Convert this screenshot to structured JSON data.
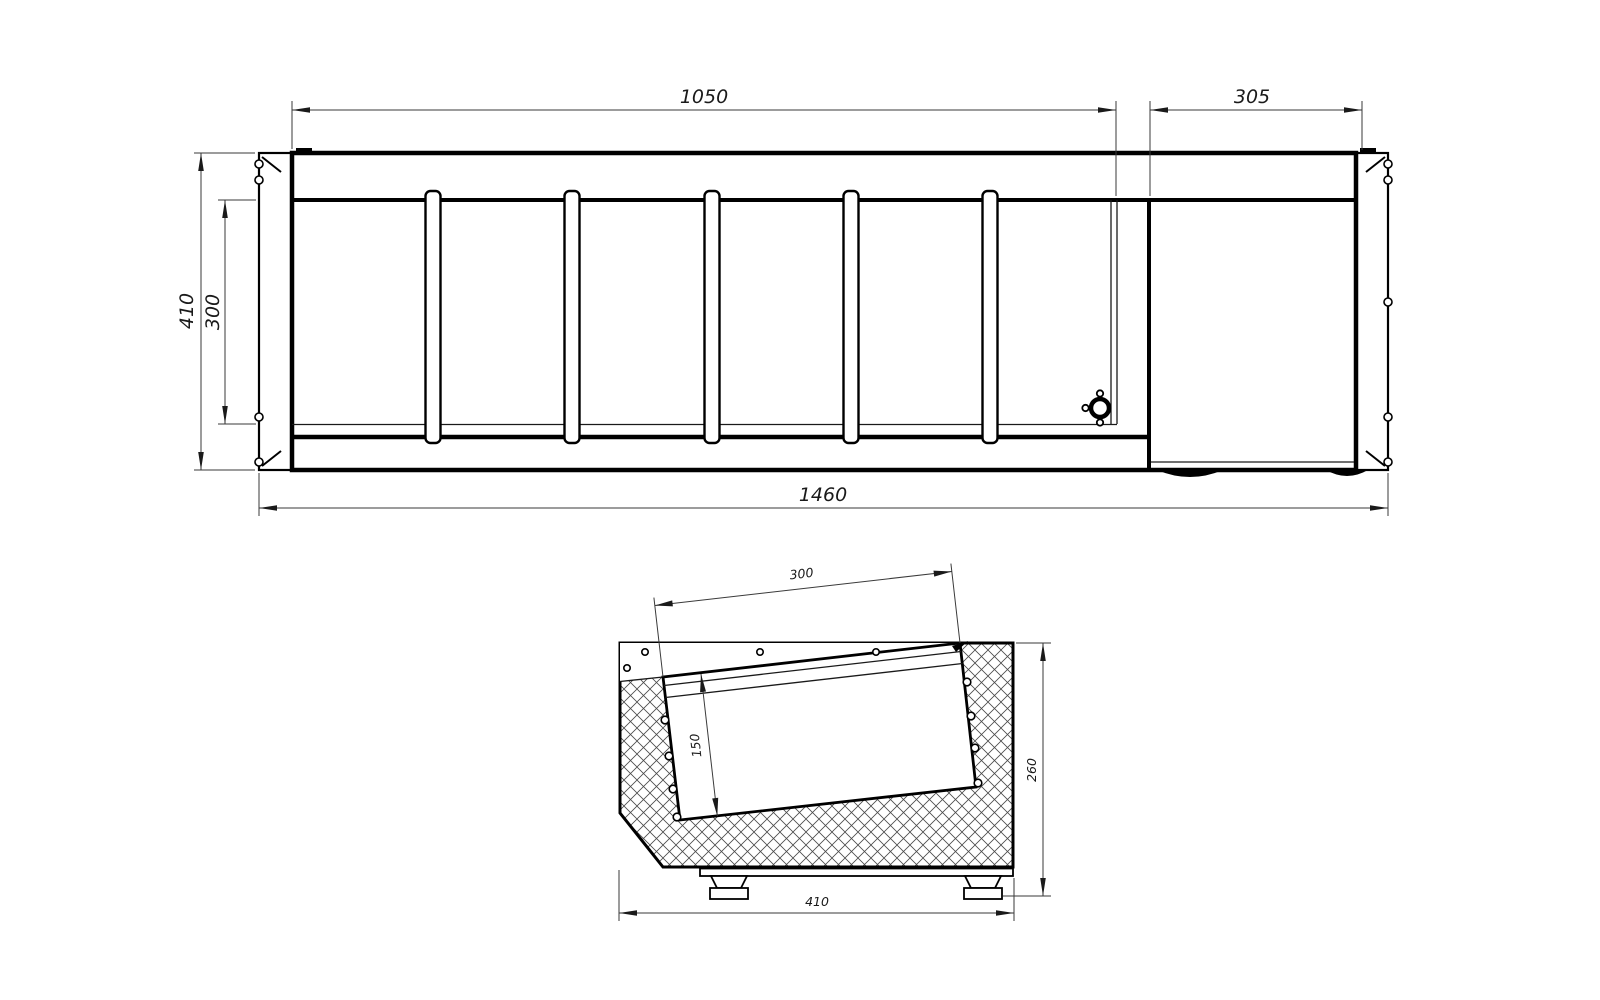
{
  "drawing": {
    "background": "#ffffff",
    "line_color": "#000000",
    "top_view": {
      "dim_width_main": "1050",
      "dim_width_right": "305",
      "dim_height_overall": "410",
      "dim_height_inner": "300",
      "dim_width_overall": "1460"
    },
    "side_view": {
      "dim_rim_width": "300",
      "dim_tub_depth": "150",
      "dim_height": "260",
      "dim_depth": "410"
    }
  }
}
